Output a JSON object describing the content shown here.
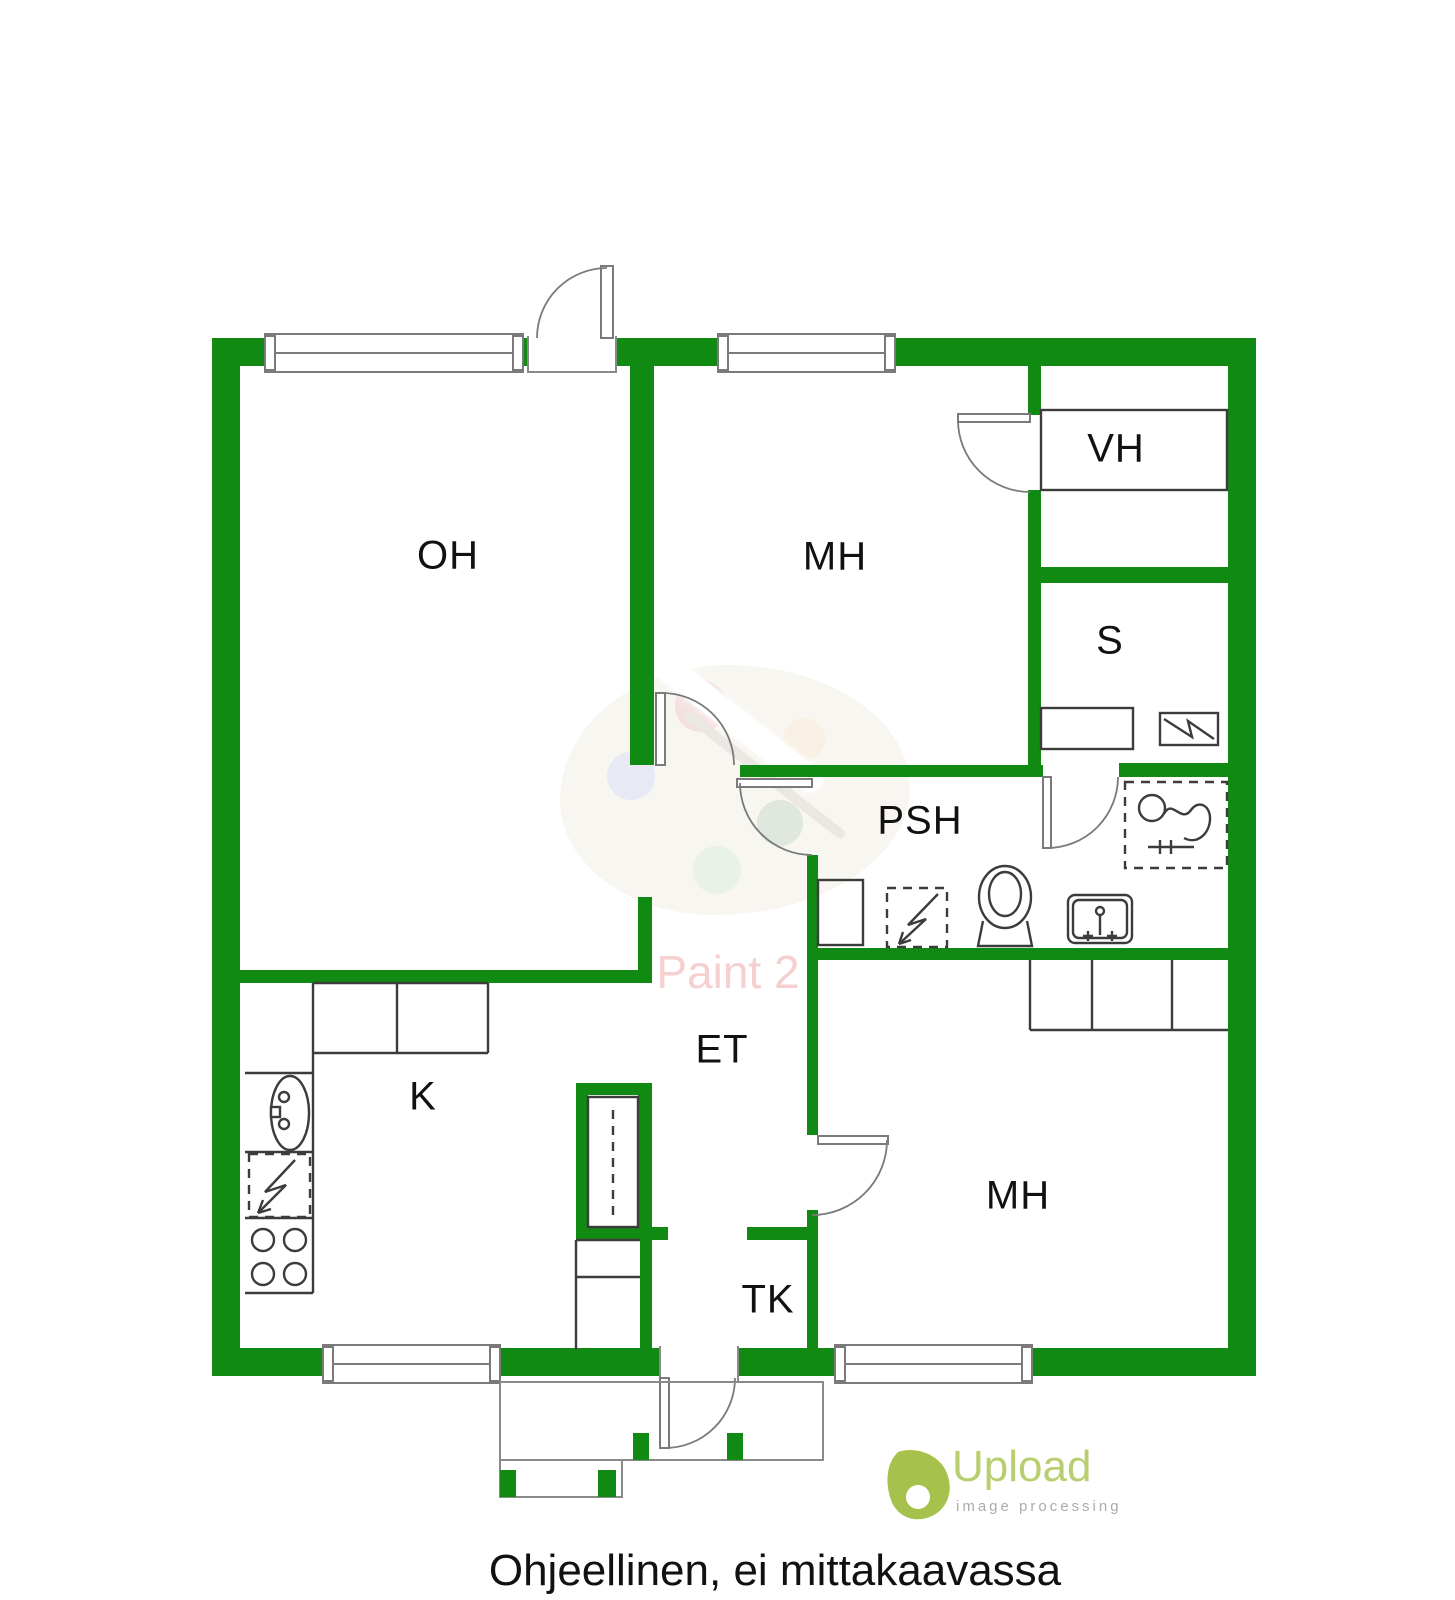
{
  "caption": "Ohjeellinen, ei mittakaavassa",
  "rooms": {
    "oh": {
      "label": "OH"
    },
    "mh_top": {
      "label": "MH"
    },
    "vh": {
      "label": "VH"
    },
    "sauna": {
      "label": "S"
    },
    "psh": {
      "label": "PSH"
    },
    "et": {
      "label": "ET"
    },
    "kitchen": {
      "label": "K"
    },
    "tk": {
      "label": "TK"
    },
    "mh_bottom": {
      "label": "MH"
    }
  },
  "watermarks": {
    "paint": {
      "text": "Paint 2"
    },
    "upload": {
      "brand": "Upload",
      "subtitle": "image processing"
    }
  },
  "fixtures": [
    "window",
    "door",
    "kitchen-counter",
    "kitchen-sink-icon",
    "dishwasher-icon",
    "stove-icon",
    "fridge-cabinet",
    "hall-wardrobe",
    "bedroom-wardrobe",
    "vh-shelf",
    "sauna-bench",
    "sauna-heater-icon",
    "shower-icon",
    "washing-machine-icon",
    "toilet-icon",
    "washbasin-icon",
    "entrance-porch"
  ],
  "colors": {
    "wall": "#108a12",
    "door_line": "#7a7a7a",
    "fixture_line": "#3c3c3c",
    "label": "#111111",
    "caption": "#111111",
    "paint_watermark": "#f0a8a8",
    "upload_brand": "#b9ce6e",
    "upload_subtitle": "#a9adad",
    "upload_icon": "#a7c24c"
  }
}
